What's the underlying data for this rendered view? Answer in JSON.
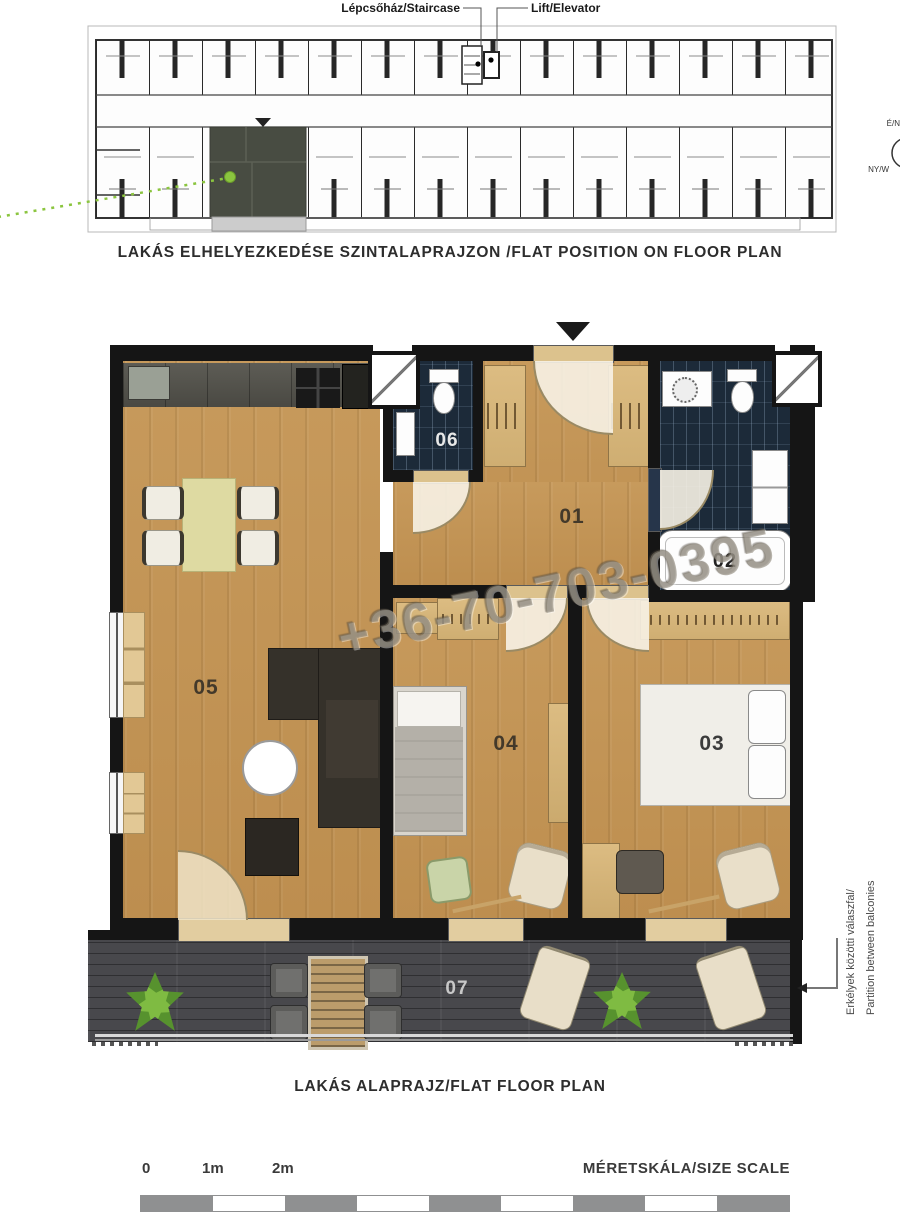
{
  "overview": {
    "staircase_label": "Lépcsőház/Staircase",
    "elevator_label": "Lift/Elevator",
    "compass_north": "É/N",
    "compass_west": "NY/W",
    "caption": "LAKÁS ELHELYEZKEDÉSE SZINTALAPRAJZON /FLAT POSITION ON FLOOR PLAN",
    "highlight_color": "#484c42",
    "marker_color": "#8bc53f"
  },
  "plan": {
    "caption": "LAKÁS ALAPRAJZ/FLAT FLOOR PLAN",
    "rooms": [
      {
        "id": "01",
        "name": "hallway"
      },
      {
        "id": "02",
        "name": "bathroom"
      },
      {
        "id": "03",
        "name": "bedroom-right"
      },
      {
        "id": "04",
        "name": "bedroom-middle"
      },
      {
        "id": "05",
        "name": "living-room-kitchen"
      },
      {
        "id": "06",
        "name": "wc"
      },
      {
        "id": "07",
        "name": "balcony"
      }
    ],
    "watermark": "+36-70-703-0395",
    "partition_note": [
      "Erkélyek közötti válaszfal/",
      "Partition between balconies"
    ]
  },
  "scale": {
    "ticks": [
      "0",
      "1m",
      "2m"
    ],
    "title": "MÉRETSKÁLA/SIZE SCALE"
  }
}
